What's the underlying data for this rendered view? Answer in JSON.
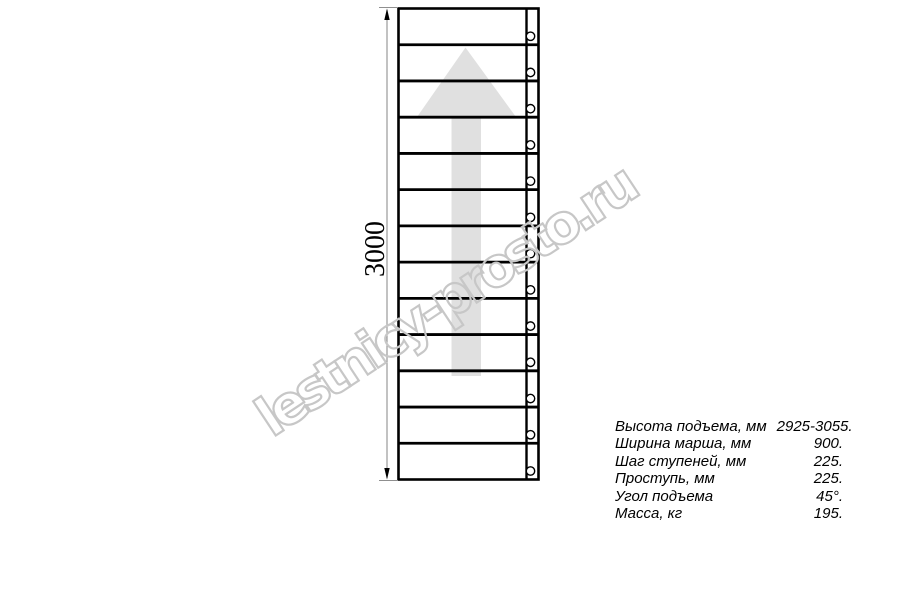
{
  "watermark": {
    "text": "lestnicy-prosto.ru"
  },
  "drawing": {
    "dimension": {
      "label": "3000"
    },
    "ladder": {
      "step_count": 13,
      "stringer_holes": 13,
      "direction": "up"
    }
  },
  "spec_table": {
    "rows": [
      {
        "label": "Высота подъема, мм",
        "value": "2925-3055."
      },
      {
        "label": "Ширина марша, мм",
        "value": "900."
      },
      {
        "label": "Шаг ступеней, мм",
        "value": "225."
      },
      {
        "label": "Проступь, мм",
        "value": "225."
      },
      {
        "label": "Угол подъема",
        "value": "45°."
      },
      {
        "label": "Масса, кг",
        "value": "195."
      }
    ]
  },
  "colors": {
    "line": "#000000",
    "arrow_fill": "#e0e0e0",
    "watermark_stroke": "#c7c7c7",
    "dimension_line": "#8f8f8f",
    "text": "#000000"
  }
}
